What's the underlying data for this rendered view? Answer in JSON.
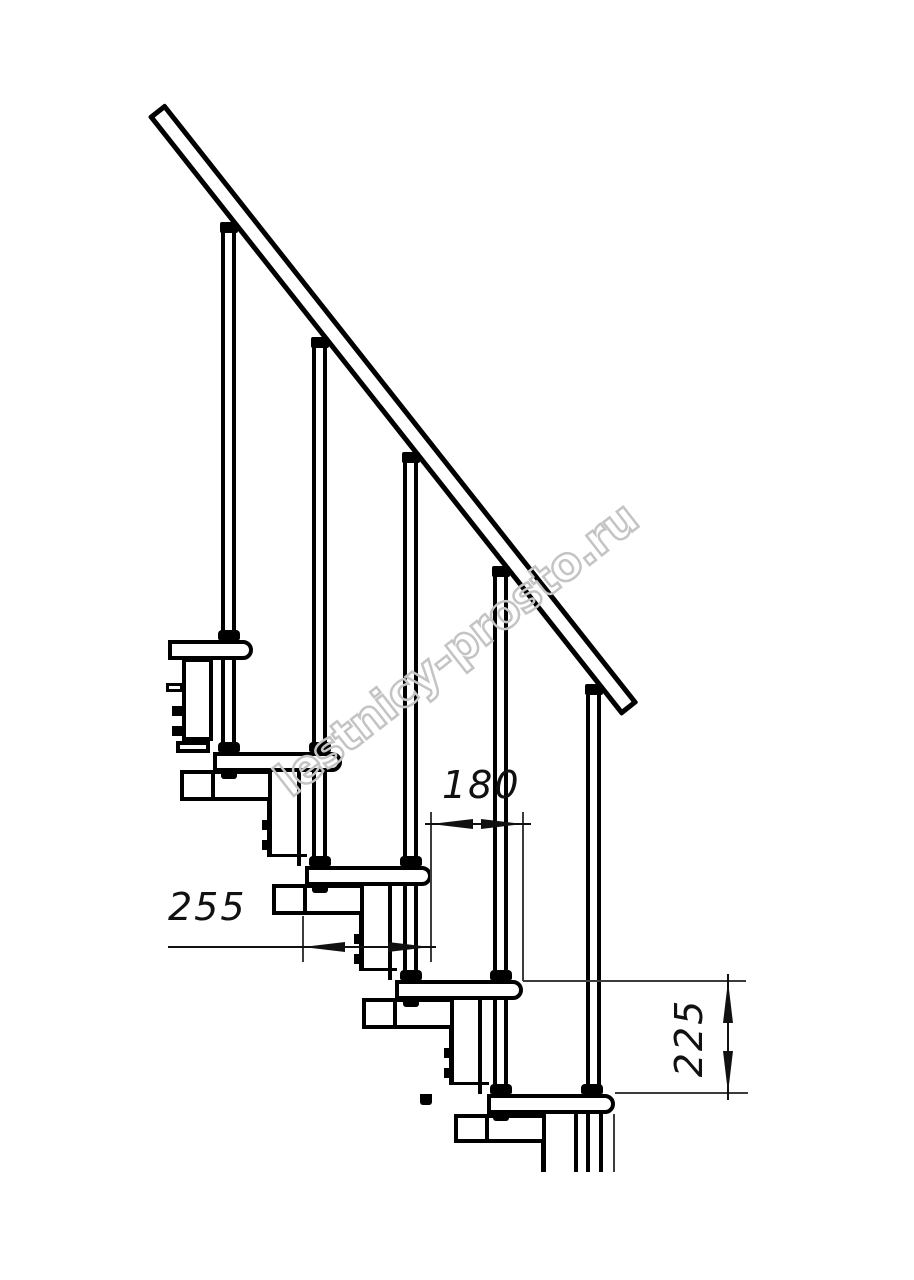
{
  "drawing": {
    "type": "staircase-side-view-technical-drawing",
    "steps_count": 5
  },
  "watermark": {
    "text": "lestnicy-prosto.ru",
    "color": "#c4c4c4"
  },
  "dimensions": {
    "tread_depth": {
      "value": "255"
    },
    "step_run": {
      "value": "180"
    },
    "riser_height": {
      "value": "225"
    }
  },
  "colors": {
    "line": "#000000",
    "background": "#ffffff",
    "dimension": "#111111",
    "extension": "#3c3c3c"
  }
}
